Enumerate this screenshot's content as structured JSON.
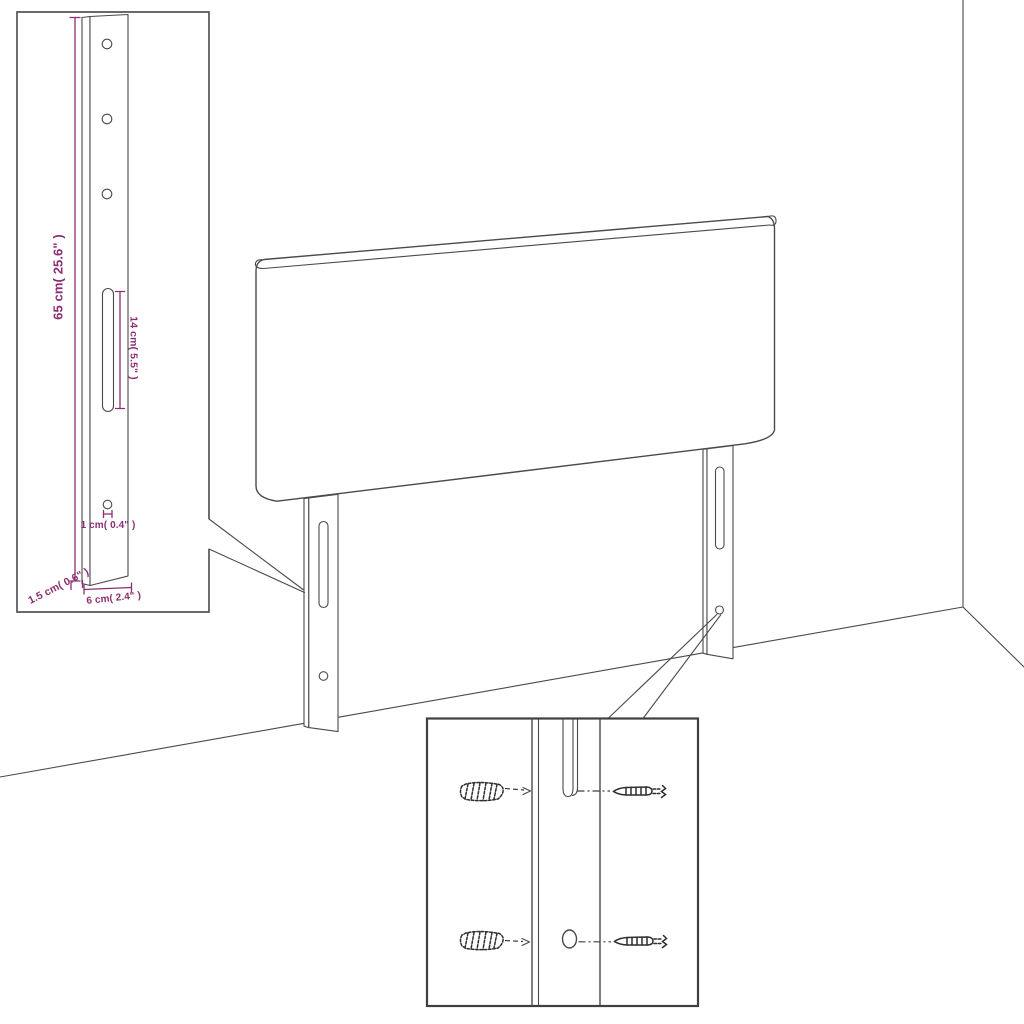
{
  "colors": {
    "background": "#ffffff",
    "line": "#4a4a4a",
    "inset_border": "#3f3f3f",
    "dimension": "#8c2e72"
  },
  "dims": {
    "height": "65 cm( 25.6\" )",
    "slot": "14 cm( 5.5\" )",
    "hole": "1 cm( 0.4\" )",
    "thickness": "1.5 cm( 0.6\" )",
    "width": "6 cm( 2.4\" )"
  }
}
